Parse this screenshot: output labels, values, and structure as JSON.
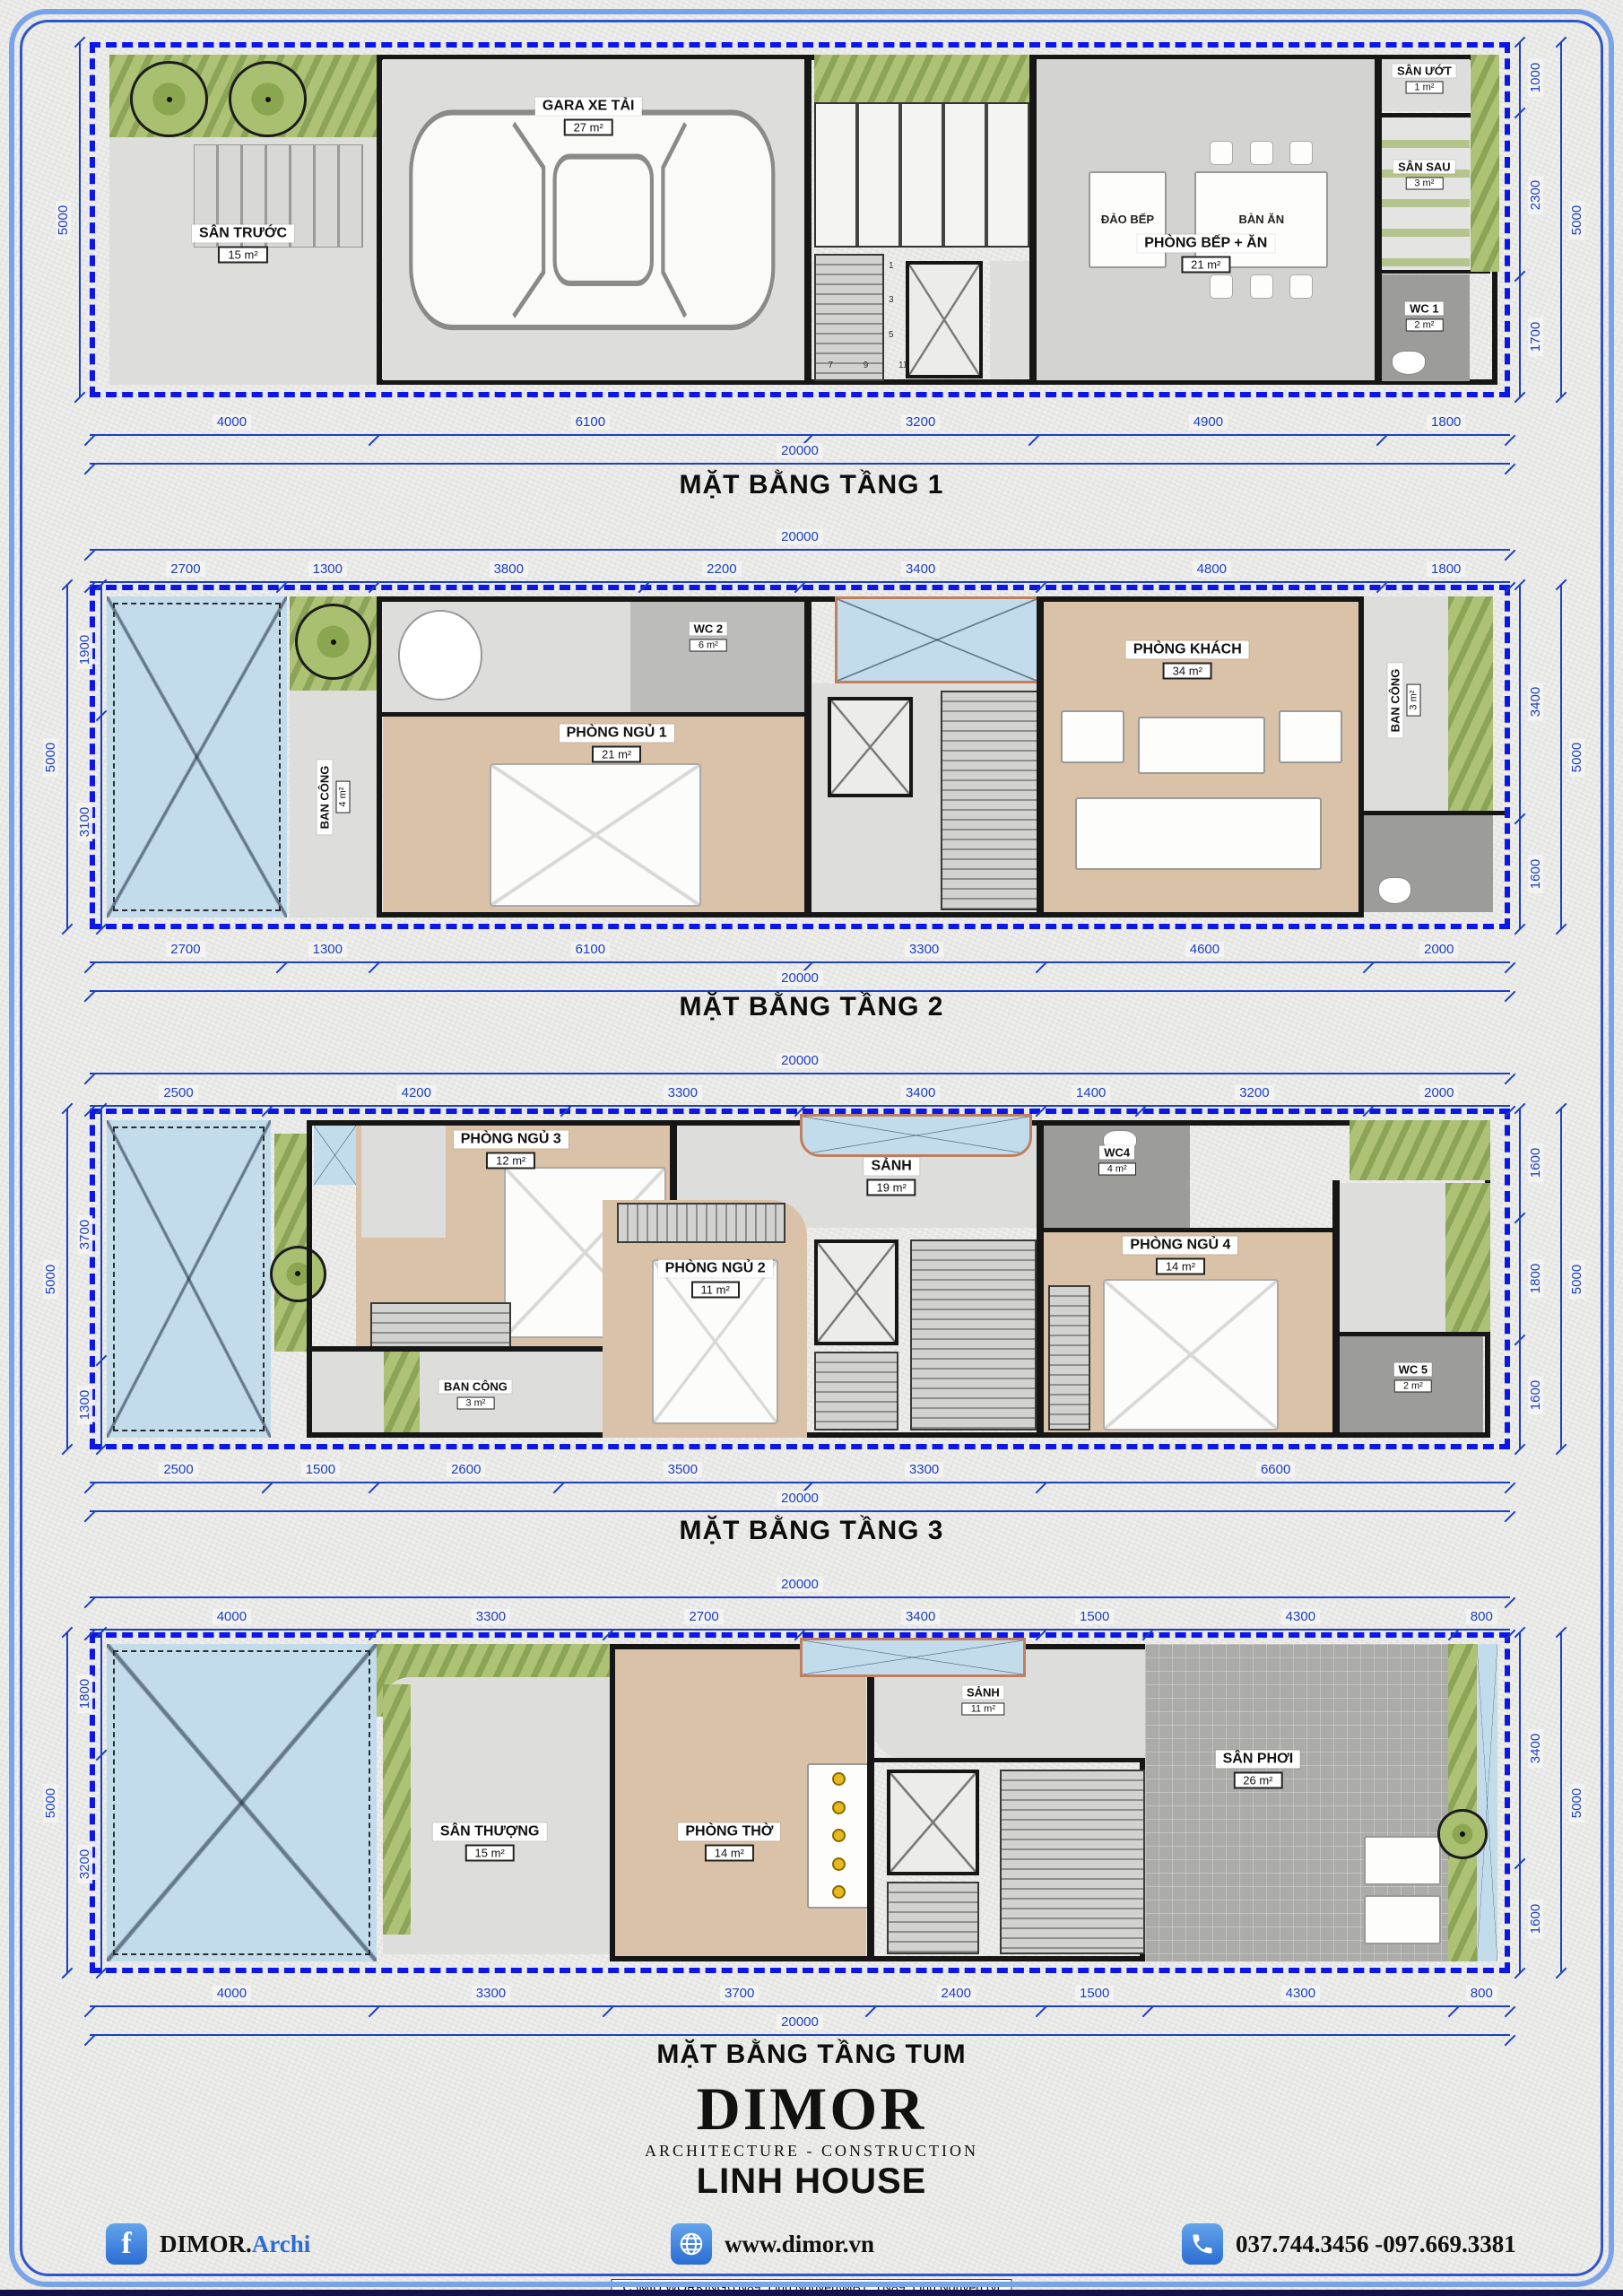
{
  "floors": [
    {
      "title": "MẶT BẰNG TẦNG 1",
      "total": 20000,
      "dims_bottom": [
        4000,
        6100,
        3200,
        4900,
        1800
      ],
      "dims_left": [
        5000
      ],
      "dims_right": [
        1000,
        2300,
        1700
      ],
      "side_total": 5000,
      "rooms": {
        "san_truoc": {
          "name": "SÂN TRƯỚC",
          "area": "15 m²"
        },
        "gara": {
          "name": "GARA XE TẢI",
          "area": "27 m²"
        },
        "bep_an": {
          "name": "PHÒNG BẾP + ĂN",
          "area": "21 m²"
        },
        "san_uot": {
          "name": "SÂN ƯỚT",
          "area": "1 m²"
        },
        "san_sau": {
          "name": "SÂN SAU",
          "area": "3 m²"
        },
        "wc1": {
          "name": "WC 1",
          "area": "2 m²"
        }
      },
      "labels": {
        "island": "ĐẢO BẾP",
        "dining": "BÀN ĂN"
      },
      "stairs": [
        "1",
        "3",
        "5",
        "7",
        "9",
        "11"
      ]
    },
    {
      "title": "MẶT BẰNG TẦNG 2",
      "total": 20000,
      "dims_top": [
        2700,
        1300,
        3800,
        2200,
        3400,
        4800,
        1800
      ],
      "dims_bottom": [
        2700,
        1300,
        6100,
        3300,
        4600,
        2000
      ],
      "dims_left": [
        1900,
        3100
      ],
      "dims_right": [
        3400,
        1600
      ],
      "side_total": 5000,
      "rooms": {
        "wc2": {
          "name": "WC 2",
          "area": "6 m²"
        },
        "ngu1": {
          "name": "PHÒNG NGỦ 1",
          "area": "21 m²"
        },
        "khach": {
          "name": "PHÒNG KHÁCH",
          "area": "34 m²"
        },
        "bancong_trai": {
          "name": "BAN CÔNG",
          "area": "4 m²"
        },
        "bancong_phai": {
          "name": "BAN CÔNG",
          "area": "3 m²"
        }
      }
    },
    {
      "title": "MẶT BẰNG TẦNG 3",
      "total": 20000,
      "dims_top": [
        2500,
        4200,
        3300,
        3400,
        1400,
        3200,
        2000
      ],
      "dims_bottom": [
        2500,
        1500,
        2600,
        3500,
        3300,
        6600
      ],
      "dims_left": [
        3700,
        1300
      ],
      "dims_right": [
        1600,
        1800,
        1600
      ],
      "side_total": 5000,
      "rooms": {
        "ngu3": {
          "name": "PHÒNG NGỦ 3",
          "area": "12 m²"
        },
        "ngu2": {
          "name": "PHÒNG NGỦ 2",
          "area": "11 m²"
        },
        "sanh": {
          "name": "SẢNH",
          "area": "19 m²"
        },
        "wc4": {
          "name": "WC4",
          "area": "4 m²"
        },
        "ngu4": {
          "name": "PHÒNG NGỦ 4",
          "area": "14 m²"
        },
        "bancong": {
          "name": "BAN CÔNG",
          "area": "3 m²"
        },
        "wc5": {
          "name": "WC 5",
          "area": "2 m²"
        }
      }
    },
    {
      "title": "MẶT BẰNG TẦNG TUM",
      "total": 20000,
      "dims_top": [
        4000,
        3300,
        2700,
        3400,
        1500,
        4300,
        800
      ],
      "dims_bottom": [
        4000,
        3300,
        3700,
        2400,
        1500,
        4300,
        800
      ],
      "dims_left": [
        1800,
        3200
      ],
      "dims_right": [
        3400,
        1600
      ],
      "side_total": 5000,
      "rooms": {
        "san_thuong": {
          "name": "SÂN THƯỢNG",
          "area": "15 m²"
        },
        "tho": {
          "name": "PHÒNG THỜ",
          "area": "14 m²"
        },
        "sanh": {
          "name": "SẢNH",
          "area": "11 m²"
        },
        "san_phoi": {
          "name": "SÂN PHƠI",
          "area": "26 m²"
        }
      }
    }
  ],
  "footer": {
    "brand": "DIMOR",
    "tagline": "ARCHITECTURE - CONSTRUCTION",
    "project": "LINH HOUSE",
    "facebook_black": "DIMOR.",
    "facebook_blue": "Archi",
    "website": "www.dimor.vn",
    "phone": "037.744.3456 -097.669.3381",
    "icons": {
      "facebook": "f"
    }
  },
  "page": {
    "file_path": "C:\\MIU WORKING\\TN89_Linh Nguyên\\MB1_TN89_Linh Nguyên.rvt"
  }
}
